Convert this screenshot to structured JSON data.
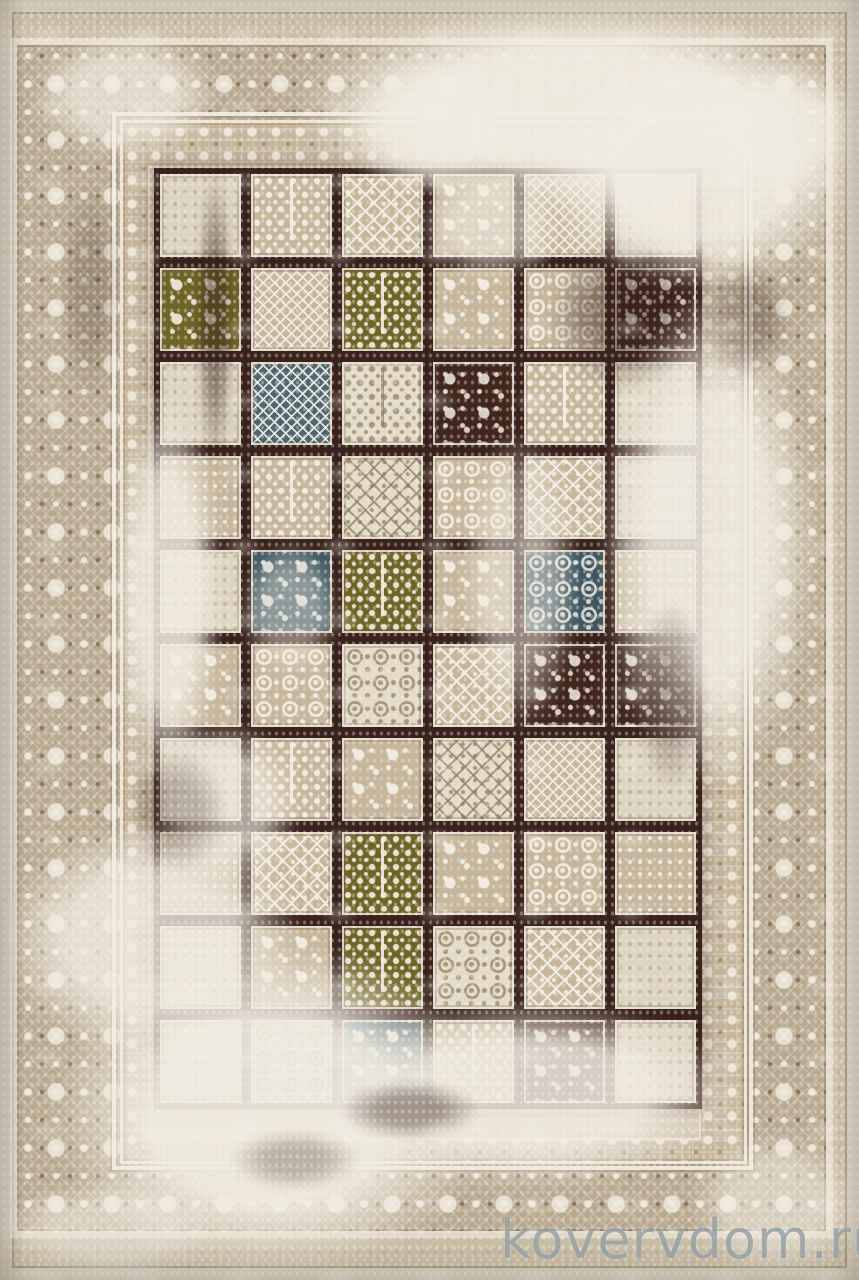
{
  "scene": {
    "subject": "vintage distressed patchwork rug, top view product photo",
    "style": "worn tile-grid field with ornamental beige borders and heavy cream abrasion"
  },
  "watermark": {
    "text": "kovervdom.ru",
    "color": "#96a0a5"
  },
  "palette": {
    "outer": "#d9d2c3",
    "band": "#b7a88f",
    "inner": "#c4b59c",
    "field": "#cfc2ab",
    "grout": "#38221b",
    "beige": "#c6b69c",
    "cream": "#e4dcca",
    "olive": "#6f6428",
    "blue": "#4d6672",
    "bluedark": "#3c5561",
    "brown": "#40261d",
    "wash": "#f1ece2",
    "wm": "#96a0a5"
  },
  "rug": {
    "grid": {
      "cols": 6,
      "rows": 10,
      "tiles": [
        [
          "faded/plain",
          "beige/tree",
          "beige/diamond",
          "beige/floral",
          "beige/lattice",
          "faded/plain"
        ],
        [
          "olive/floral",
          "beige/lattice",
          "olive/tree",
          "beige/floral",
          "beige/ornate",
          "brown/floral"
        ],
        [
          "faded/plain",
          "blue/lattice",
          "cream/tree",
          "brown/floral",
          "beige/tree",
          "faded/plain"
        ],
        [
          "beige/plain",
          "beige/tree",
          "cream/diamond",
          "beige/ornate",
          "beige/diamond",
          "faded/plain"
        ],
        [
          "faded/plain",
          "bluedark/floral",
          "olive/tree",
          "beige/floral",
          "bluedark/ornate",
          "beige/plain"
        ],
        [
          "beige/floral",
          "beige/ornate",
          "cream/ornate",
          "beige/diamond",
          "brown/floral",
          "brown/floral"
        ],
        [
          "faded/plain",
          "beige/tree",
          "beige/floral",
          "cream/diamond",
          "beige/lattice",
          "faded/plain"
        ],
        [
          "beige/plain",
          "beige/diamond",
          "olive/tree",
          "beige/floral",
          "beige/ornate",
          "beige/plain"
        ],
        [
          "faded/plain",
          "beige/floral",
          "olive/tree",
          "cream/ornate",
          "beige/diamond",
          "faded/plain"
        ],
        [
          "faded/plain",
          "cream/ornate",
          "blue/floral",
          "beige/tree",
          "brown/floral",
          "faded/plain"
        ]
      ]
    }
  },
  "distress": {
    "light": [
      [
        290,
        0,
        570,
        210,
        0.95
      ],
      [
        540,
        60,
        320,
        230,
        0.9
      ],
      [
        30,
        30,
        190,
        130,
        0.7
      ],
      [
        340,
        60,
        180,
        130,
        0.8
      ],
      [
        600,
        290,
        220,
        500,
        0.88
      ],
      [
        112,
        390,
        110,
        400,
        0.85
      ],
      [
        0,
        820,
        300,
        240,
        0.8
      ],
      [
        50,
        940,
        440,
        340,
        0.92
      ],
      [
        320,
        1000,
        420,
        190,
        0.85
      ],
      [
        150,
        720,
        150,
        170,
        0.65
      ],
      [
        420,
        170,
        140,
        110,
        0.6
      ],
      [
        690,
        1130,
        170,
        150,
        0.55
      ],
      [
        0,
        1180,
        220,
        100,
        0.55
      ],
      [
        240,
        540,
        100,
        140,
        0.45
      ],
      [
        700,
        60,
        160,
        140,
        0.8
      ],
      [
        460,
        430,
        120,
        300,
        0.5
      ]
    ],
    "dark": [
      [
        196,
        170,
        38,
        300,
        0.55
      ],
      [
        548,
        240,
        150,
        150,
        0.5
      ],
      [
        340,
        1080,
        140,
        60,
        0.45
      ],
      [
        128,
        750,
        100,
        120,
        0.3
      ],
      [
        636,
        600,
        70,
        190,
        0.35
      ],
      [
        230,
        1130,
        130,
        60,
        0.3
      ],
      [
        60,
        180,
        60,
        220,
        0.25
      ],
      [
        700,
        260,
        90,
        120,
        0.35
      ]
    ]
  }
}
